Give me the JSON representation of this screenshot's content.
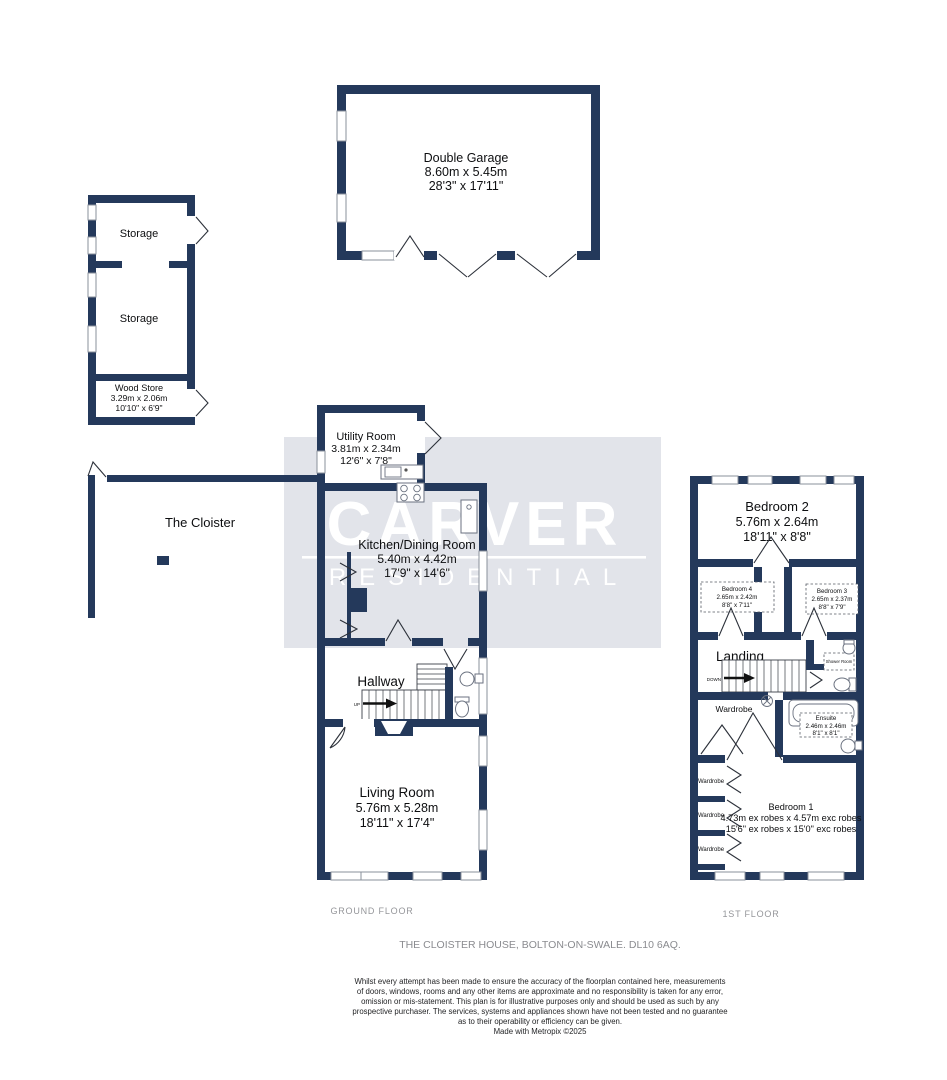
{
  "watermark": {
    "brand": "CARVER",
    "brand_sub": "RESIDENTIAL"
  },
  "rooms": {
    "double_garage": {
      "name": "Double Garage",
      "metric": "8.60m x 5.45m",
      "imperial": "28'3\" x 17'11\""
    },
    "storage_top": {
      "name": "Storage"
    },
    "storage_mid": {
      "name": "Storage"
    },
    "wood_store": {
      "name": "Wood Store",
      "metric": "3.29m x 2.06m",
      "imperial": "10'10\" x 6'9\""
    },
    "utility": {
      "name": "Utility Room",
      "metric": "3.81m x 2.34m",
      "imperial": "12'6\" x 7'8\""
    },
    "cloister": {
      "name": "The Cloister"
    },
    "kitchen": {
      "name": "Kitchen/Dining Room",
      "metric": "5.40m x 4.42m",
      "imperial": "17'9\" x 14'6\""
    },
    "hallway": {
      "name": "Hallway"
    },
    "living": {
      "name": "Living Room",
      "metric": "5.76m x 5.28m",
      "imperial": "18'11\" x 17'4\""
    },
    "bedroom2": {
      "name": "Bedroom 2",
      "metric": "5.76m x 2.64m",
      "imperial": "18'11\" x 8'8\""
    },
    "bedroom4": {
      "name": "Bedroom 4",
      "metric": "2.65m x 2.42m",
      "imperial": "8'8\" x 7'11\""
    },
    "bedroom3": {
      "name": "Bedroom 3",
      "metric": "2.65m x 2.37m",
      "imperial": "8'8\" x 7'9\""
    },
    "landing": {
      "name": "Landing"
    },
    "shower_room": {
      "name": "Shower Room"
    },
    "wardrobe": {
      "name": "Wardrobe"
    },
    "ensuite": {
      "name": "Ensuite",
      "metric": "2.46m x 2.46m",
      "imperial": "8'1\" x 8'1\""
    },
    "bedroom1": {
      "name": "Bedroom 1",
      "metric": "4.73m ex robes x 4.57m exc robes",
      "imperial": "15'6\" ex robes x 15'0\" exc robes"
    }
  },
  "stairs": {
    "up": "UP",
    "down": "DOWN"
  },
  "floors": {
    "ground_label": "GROUND FLOOR",
    "first_label": "1ST FLOOR"
  },
  "address": "THE CLOISTER HOUSE, BOLTON-ON-SWALE. DL10 6AQ.",
  "disclaimer": {
    "line1": "Whilst every attempt has been made to ensure the accuracy of the floorplan contained here, measurements",
    "line2": "of doors, windows, rooms and any other items are approximate and no responsibility is taken for any error,",
    "line3": "omission or mis-statement. This plan is for illustrative purposes only and should be used as such by any",
    "line4": "prospective purchaser. The services, systems and appliances shown have not been tested and no guarantee",
    "line5": "as to their operability or efficiency can be given.",
    "credit": "Made with Metropix ©2025"
  },
  "colors": {
    "wall": "#24395B",
    "watermark_bg": "#E2E4EA",
    "watermark_text": "#FFFFFF"
  }
}
